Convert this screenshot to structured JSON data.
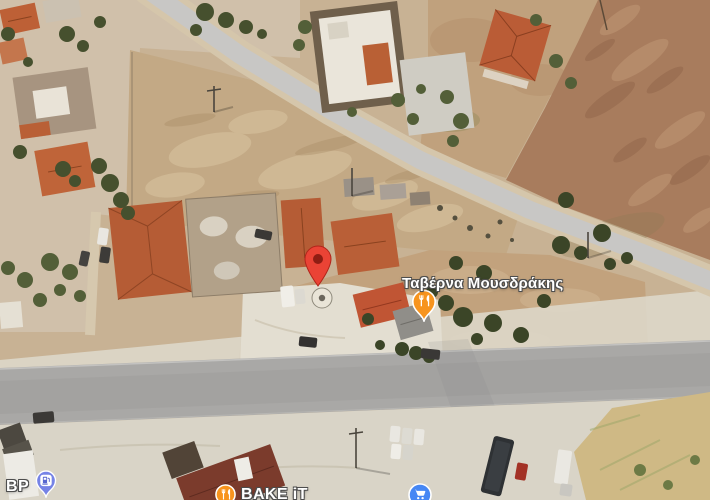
{
  "map": {
    "view_type": "satellite-imagery",
    "label_text_color": "#FFFFFF",
    "label_halo_color": "#4D4D4D",
    "markers": {
      "dropped_pin": {
        "type": "destination-pin",
        "color": "#EA4335"
      },
      "taverna": {
        "label": "Ταβέρνα Μουσδράκης",
        "category": "restaurant",
        "pin_color": "#F7941E"
      },
      "bp": {
        "label": "BP",
        "category": "gas-station",
        "pin_color": "#7683E6"
      },
      "bake_it": {
        "label": "BAKE iT",
        "category": "restaurant",
        "badge_color": "#F7941E"
      },
      "grocery": {
        "category": "grocery-store",
        "badge_color": "#4687F4"
      }
    }
  }
}
